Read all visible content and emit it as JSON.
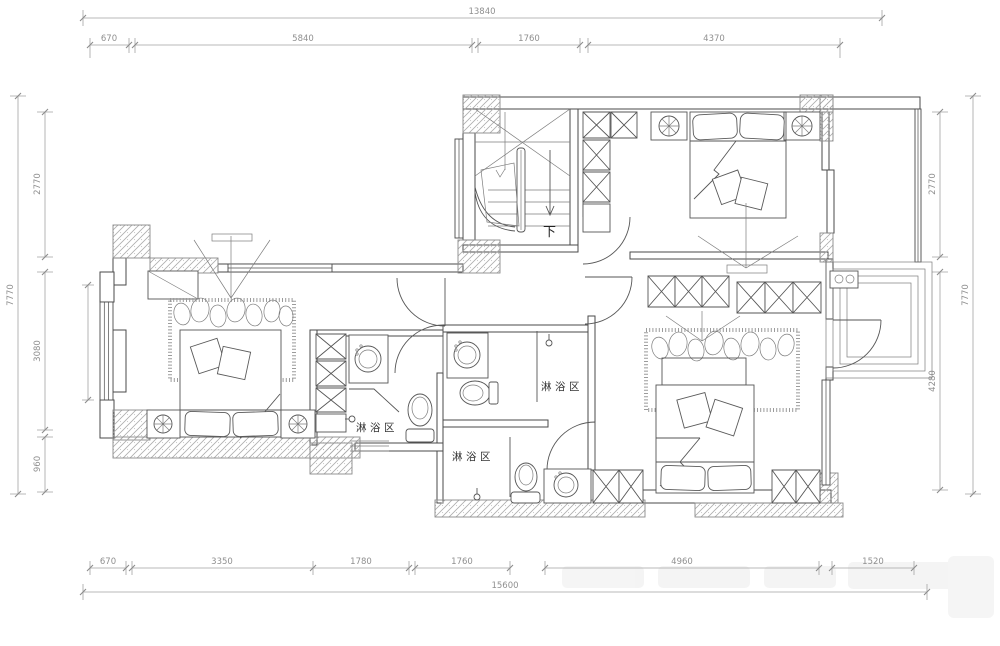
{
  "plan": {
    "labels": {
      "shower_areas": [
        "淋浴区",
        "淋浴区",
        "淋浴区"
      ],
      "stairs_down": "下"
    },
    "dimensions": {
      "top": {
        "overall": "13840",
        "segments": [
          "670",
          "5840",
          "1760",
          "4370"
        ]
      },
      "bottom": {
        "overall": "15600",
        "segments": [
          "670",
          "3350",
          "1780",
          "1760",
          "4960",
          "1520"
        ]
      },
      "left": {
        "overall": "7770",
        "segments": [
          "2770",
          "3080",
          "960"
        ]
      },
      "right": {
        "overall": "7770",
        "segments": [
          "2770",
          "4280"
        ]
      }
    },
    "colors": {
      "background": "#ffffff",
      "wall_line": "#4a4a4a",
      "dim_line": "#a3a3a3",
      "dim_text": "#8f8f8f",
      "label_text": "#333333",
      "hatch": "#adadad"
    }
  }
}
